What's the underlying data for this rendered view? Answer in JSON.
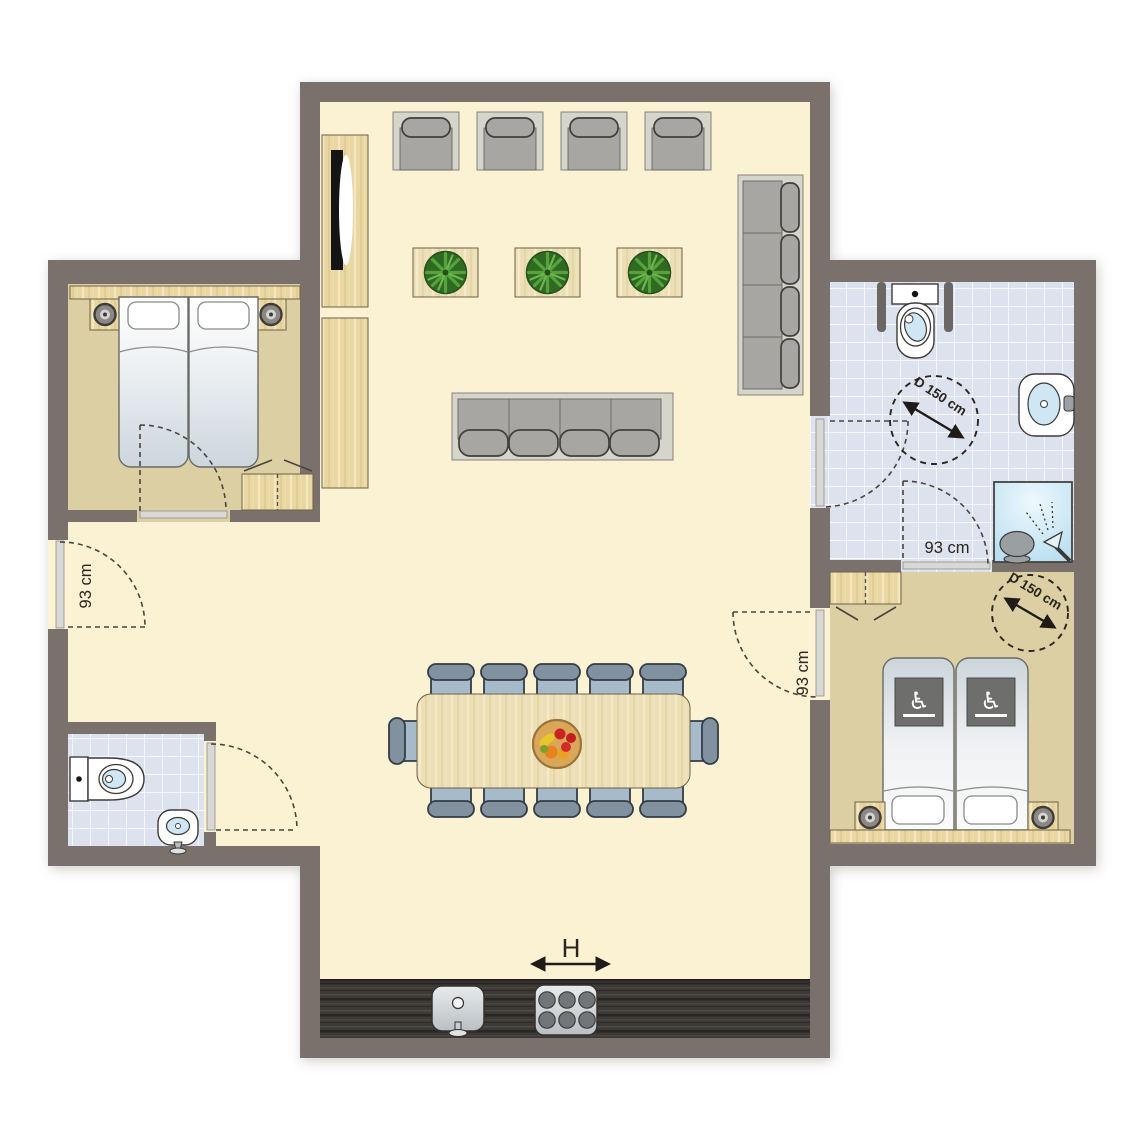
{
  "diagram": {
    "type": "floor-plan",
    "description_visible_text_only": true
  },
  "labels": {
    "door_left": "93 cm",
    "door_bedroom": "93 cm",
    "door_bathroom": "93 cm",
    "circle_bathroom": "D 150 cm",
    "circle_bedroom": "D 150 cm",
    "hob": "H"
  },
  "icons": {
    "accessible_bed": "♿"
  },
  "colors": {
    "wall": "#7a716d",
    "floor_living": "#fbf1d3",
    "floor_bedroom": "#dccfa4",
    "floor_tile": "#dce2ee",
    "wood": "#ebdcae",
    "kitchen_counter": "#3d3936",
    "upholstery": "#a7a6a2",
    "upholstery_frame": "#d5d5cb",
    "dining_chair_seat": "#a7bac9",
    "dining_chair_back": "#8191a0",
    "shower": "#bfe3f3",
    "basin_water": "#cfe6f4",
    "plant": "#57a33b",
    "fruit_bowl": "#d9a757",
    "accessible_icon_panel": "#6e6e6c",
    "label_text": "#2a2520"
  }
}
